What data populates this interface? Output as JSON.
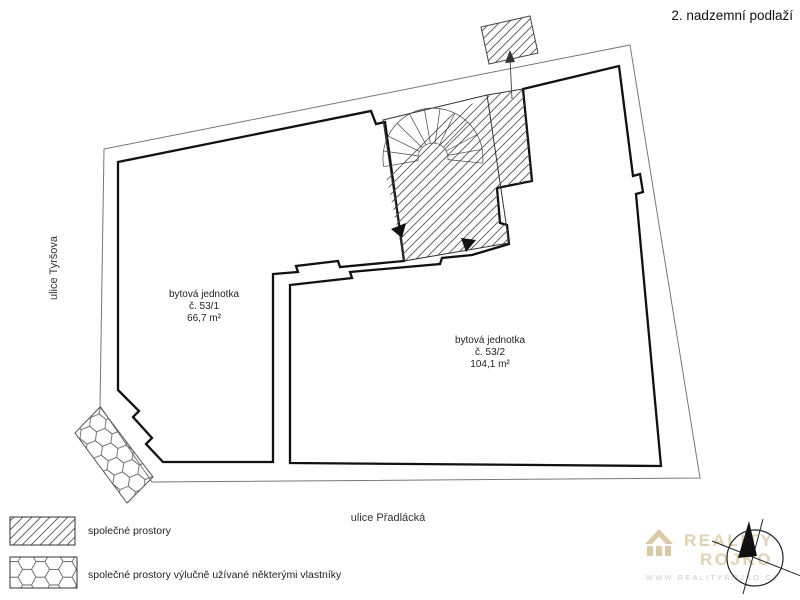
{
  "title": "2. nadzemní podlaží",
  "streets": {
    "left": "ulice Tyršova",
    "bottom": "ulice Přadlácká"
  },
  "units": [
    {
      "line1": "bytová jednotka",
      "line2": "č. 53/1",
      "line3": "66,7 m²"
    },
    {
      "line1": "bytová jednotka",
      "line2": "č. 53/2",
      "line3": "104,1 m²"
    }
  ],
  "legend": {
    "items": [
      {
        "pattern": "diagonal-hatch",
        "label": "společné prostory"
      },
      {
        "pattern": "hexagon",
        "label": "společné prostory výlučně užívané některými vlastníky"
      }
    ]
  },
  "watermark": {
    "brand_line1": "REALITY",
    "brand_line2": "ROJKO",
    "website": "WWW.REALITYROJKO.CZ"
  },
  "colors": {
    "wall": "#111111",
    "thin_line": "#777777",
    "stair_line": "#333333",
    "watermark_tan": "#d8c59c",
    "watermark_gray": "#c6c6c6"
  }
}
